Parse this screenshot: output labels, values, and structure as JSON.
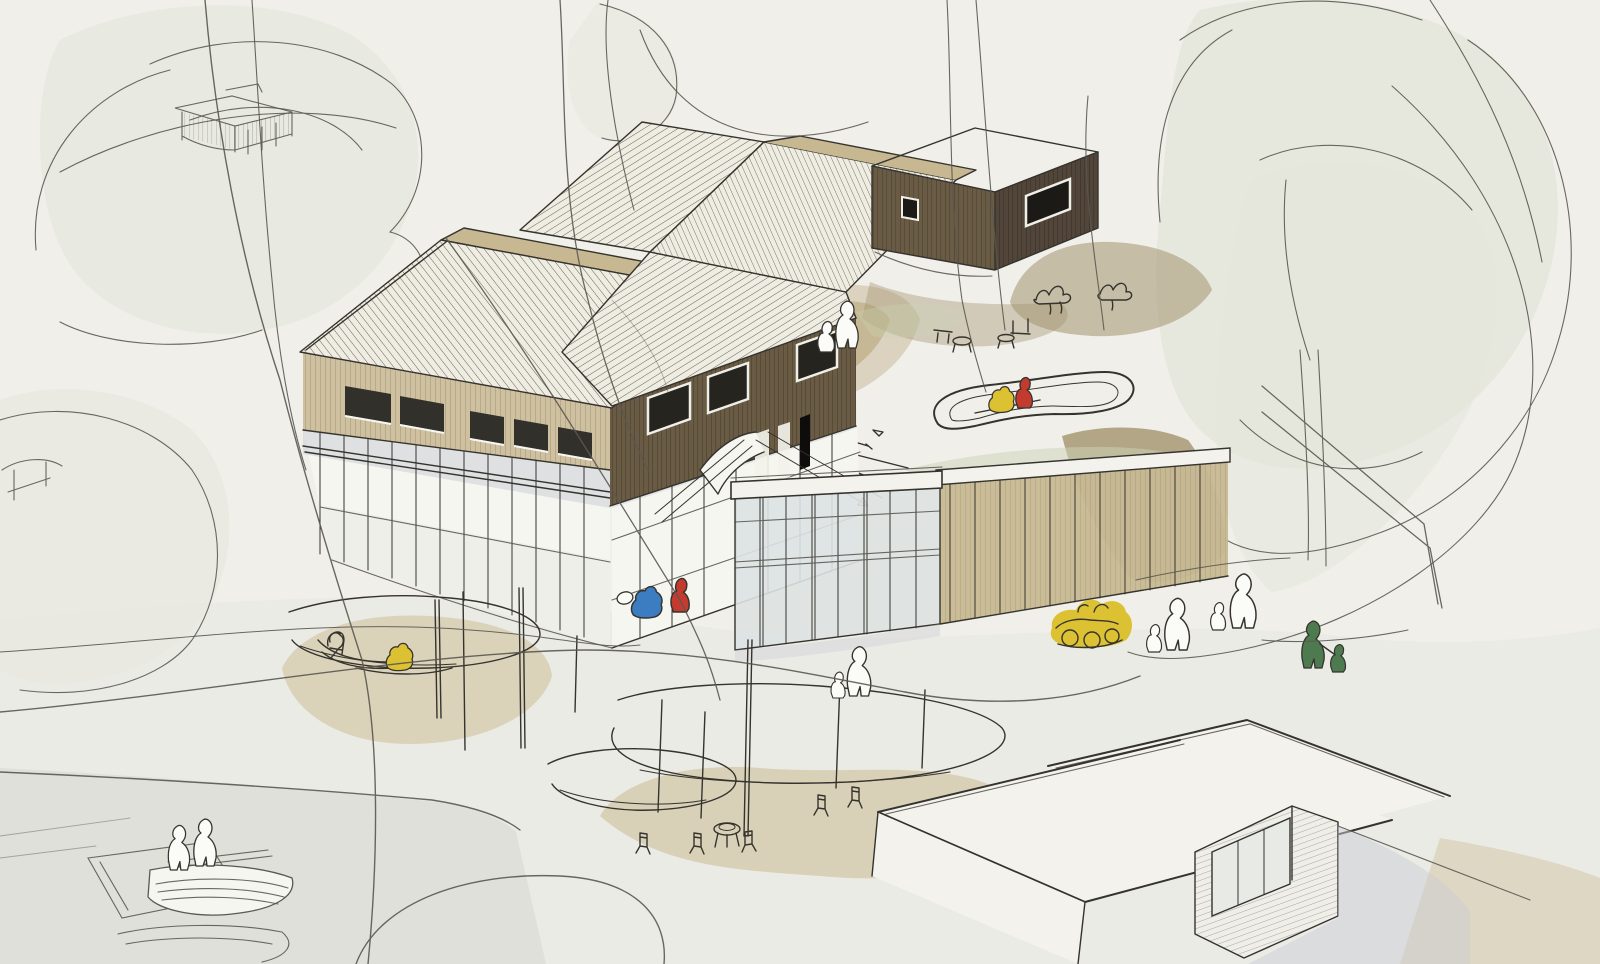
{
  "artwork": {
    "kind": "hand-drawn architectural concept sketch, ink line with watercolor wash",
    "view": "aerial axonometric perspective",
    "elements": [
      "timber building complex with zigzag pitched roofs on a glazed plinth",
      "dark wood box annex",
      "glass pavilion with rooftop play terrace and loop track",
      "white flat-roofed outbuilding at lower right",
      "round canopy shelters with cafe tables and chairs",
      "rowing boats and jetty at lower left shore",
      "trees drawn as loose looping outlines with pale washes",
      "small human silhouettes, most white, a few in accent colors",
      "tree house platform sketched upper left"
    ]
  },
  "palette": {
    "paper": "#f0efea",
    "ink": "#35332e",
    "sketch_line": "#5a5850",
    "tree_wash": "#e3e5da",
    "ground_wash": "#e7e8e1",
    "water_wash": "#dcddd6",
    "shadow_wash": "#ccced6",
    "tan_wash": "#c2b28d",
    "tan_wash_light": "#d5caab",
    "olive_wash": "#a2946e",
    "facade_light": "#cfc1a0",
    "facade_dark": "#6a5b45",
    "facade_darker": "#52463a",
    "roof_light": "#efece2",
    "gable_tan": "#c7b892",
    "window_dark": "#32302b",
    "glass": "#dde2e2",
    "green_roof": "#cbd3b4",
    "figure_white": "#fbfbf7",
    "figure_red": "#c23b2e",
    "figure_blue": "#3b7dc0",
    "figure_yellow": "#dcc133",
    "figure_green": "#4d7a4f"
  },
  "figures": [
    {
      "name": "child-crouching-blue",
      "color": "figure_blue",
      "location": "plaza below dark facade"
    },
    {
      "name": "child-crouching-red",
      "color": "figure_red",
      "location": "plaza below dark facade"
    },
    {
      "name": "child-yellow",
      "color": "figure_yellow",
      "location": "left playground circle"
    },
    {
      "name": "children-on-toy-vehicle-yellow",
      "color": "figure_yellow",
      "location": "path right of pavilion"
    },
    {
      "name": "adult-and-child-green",
      "color": "figure_green",
      "location": "far right path"
    },
    {
      "name": "children-on-roof-track-red-yellow",
      "color": "figure_red",
      "location": "pavilion roof terrace"
    },
    {
      "name": "white-silhouette-pairs",
      "color": "figure_white",
      "location": "entry slope, plaza, paths, boats"
    }
  ]
}
